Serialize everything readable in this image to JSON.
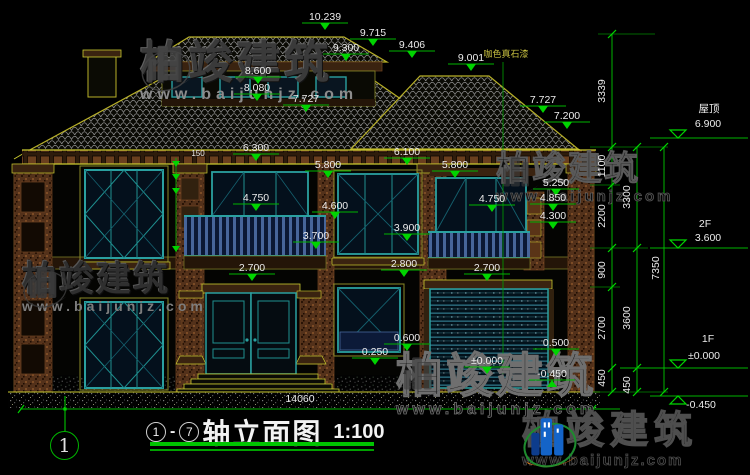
{
  "title": {
    "axis_from": "1",
    "separator": "-",
    "axis_to": "7",
    "name": "轴立面图",
    "scale": "1:100"
  },
  "axis_bubble": {
    "label": "1"
  },
  "watermark": {
    "brand": "柏竣建筑",
    "url": "www.baijunjz.com"
  },
  "logo": {
    "brand": "柏竣建筑",
    "url": "www.baijunjz.com"
  },
  "colors": {
    "dim_text": "#ececec",
    "dim_line": "#00b400",
    "flag": "#00d400",
    "material_note": "#c8c040"
  },
  "labels": [
    {
      "t": "10.239",
      "x": 325,
      "y": 20
    },
    {
      "t": "9.715",
      "x": 373,
      "y": 36
    },
    {
      "t": "9.300",
      "x": 346,
      "y": 51
    },
    {
      "t": "9.406",
      "x": 412,
      "y": 48
    },
    {
      "t": "9.001",
      "x": 471,
      "y": 61
    },
    {
      "t": "8.600",
      "x": 258,
      "y": 74
    },
    {
      "t": "8.080",
      "x": 257,
      "y": 91
    },
    {
      "t": "7.727",
      "x": 306,
      "y": 102
    },
    {
      "t": "7.727",
      "x": 543,
      "y": 103
    },
    {
      "t": "7.200",
      "x": 567,
      "y": 119
    },
    {
      "t": "6.300",
      "x": 256,
      "y": 151
    },
    {
      "t": "6.100",
      "x": 407,
      "y": 155
    },
    {
      "t": "5.800",
      "x": 328,
      "y": 168
    },
    {
      "t": "5.800",
      "x": 455,
      "y": 168
    },
    {
      "t": "5.250",
      "x": 556,
      "y": 186
    },
    {
      "t": "4.850",
      "x": 553,
      "y": 201
    },
    {
      "t": "4.750",
      "x": 256,
      "y": 201
    },
    {
      "t": "4.750",
      "x": 492,
      "y": 202
    },
    {
      "t": "4.600",
      "x": 335,
      "y": 209
    },
    {
      "t": "4.300",
      "x": 553,
      "y": 219
    },
    {
      "t": "3.900",
      "x": 407,
      "y": 231
    },
    {
      "t": "3.700",
      "x": 316,
      "y": 239
    },
    {
      "t": "2.800",
      "x": 404,
      "y": 267
    },
    {
      "t": "2.700",
      "x": 252,
      "y": 271
    },
    {
      "t": "2.700",
      "x": 487,
      "y": 271
    },
    {
      "t": "0.600",
      "x": 407,
      "y": 341
    },
    {
      "t": "0.250",
      "x": 375,
      "y": 355
    },
    {
      "t": "0.500",
      "x": 556,
      "y": 346
    },
    {
      "t": "±0.000",
      "x": 487,
      "y": 364
    },
    {
      "t": "-0.450",
      "x": 552,
      "y": 377,
      "f": "up"
    },
    {
      "t": "150",
      "x": 198,
      "y": 156,
      "s": 8,
      "f": "none"
    },
    {
      "t": "咖色真石漆",
      "x": 506,
      "y": 57,
      "s": 9,
      "c": "#c8c040",
      "f": "none",
      "n": "material-note"
    },
    {
      "t": "屋顶",
      "x": 709,
      "y": 112,
      "f": "none",
      "n": "level-label"
    },
    {
      "t": "6.900",
      "x": 708,
      "y": 127,
      "f": "none",
      "n": "level-label"
    },
    {
      "t": "2F",
      "x": 705,
      "y": 227,
      "f": "none",
      "n": "level-label"
    },
    {
      "t": "3.600",
      "x": 708,
      "y": 241,
      "f": "none",
      "n": "level-label"
    },
    {
      "t": "1F",
      "x": 708,
      "y": 342,
      "f": "none",
      "n": "level-label"
    },
    {
      "t": "±0.000",
      "x": 704,
      "y": 359,
      "f": "none",
      "n": "level-label"
    },
    {
      "t": "-0.450",
      "x": 701,
      "y": 408,
      "f": "none",
      "n": "level-label"
    },
    {
      "t": "3339",
      "x": 605,
      "y": 91,
      "r": -90,
      "f": "none"
    },
    {
      "t": "1100",
      "x": 605,
      "y": 166,
      "r": -90,
      "f": "none"
    },
    {
      "t": "2200",
      "x": 605,
      "y": 216,
      "r": -90,
      "f": "none"
    },
    {
      "t": "900",
      "x": 605,
      "y": 270,
      "r": -90,
      "f": "none"
    },
    {
      "t": "2700",
      "x": 605,
      "y": 328,
      "r": -90,
      "f": "none"
    },
    {
      "t": "450",
      "x": 605,
      "y": 378,
      "r": -90,
      "f": "none"
    },
    {
      "t": "3300",
      "x": 630,
      "y": 197,
      "r": -90,
      "f": "none"
    },
    {
      "t": "3600",
      "x": 630,
      "y": 318,
      "r": -90,
      "f": "none"
    },
    {
      "t": "450",
      "x": 630,
      "y": 385,
      "r": -90,
      "f": "none"
    },
    {
      "t": "7350",
      "x": 659,
      "y": 268,
      "r": -90,
      "f": "none"
    },
    {
      "t": "14060",
      "x": 300,
      "y": 402,
      "f": "none",
      "n": "overall-width-dim"
    }
  ]
}
